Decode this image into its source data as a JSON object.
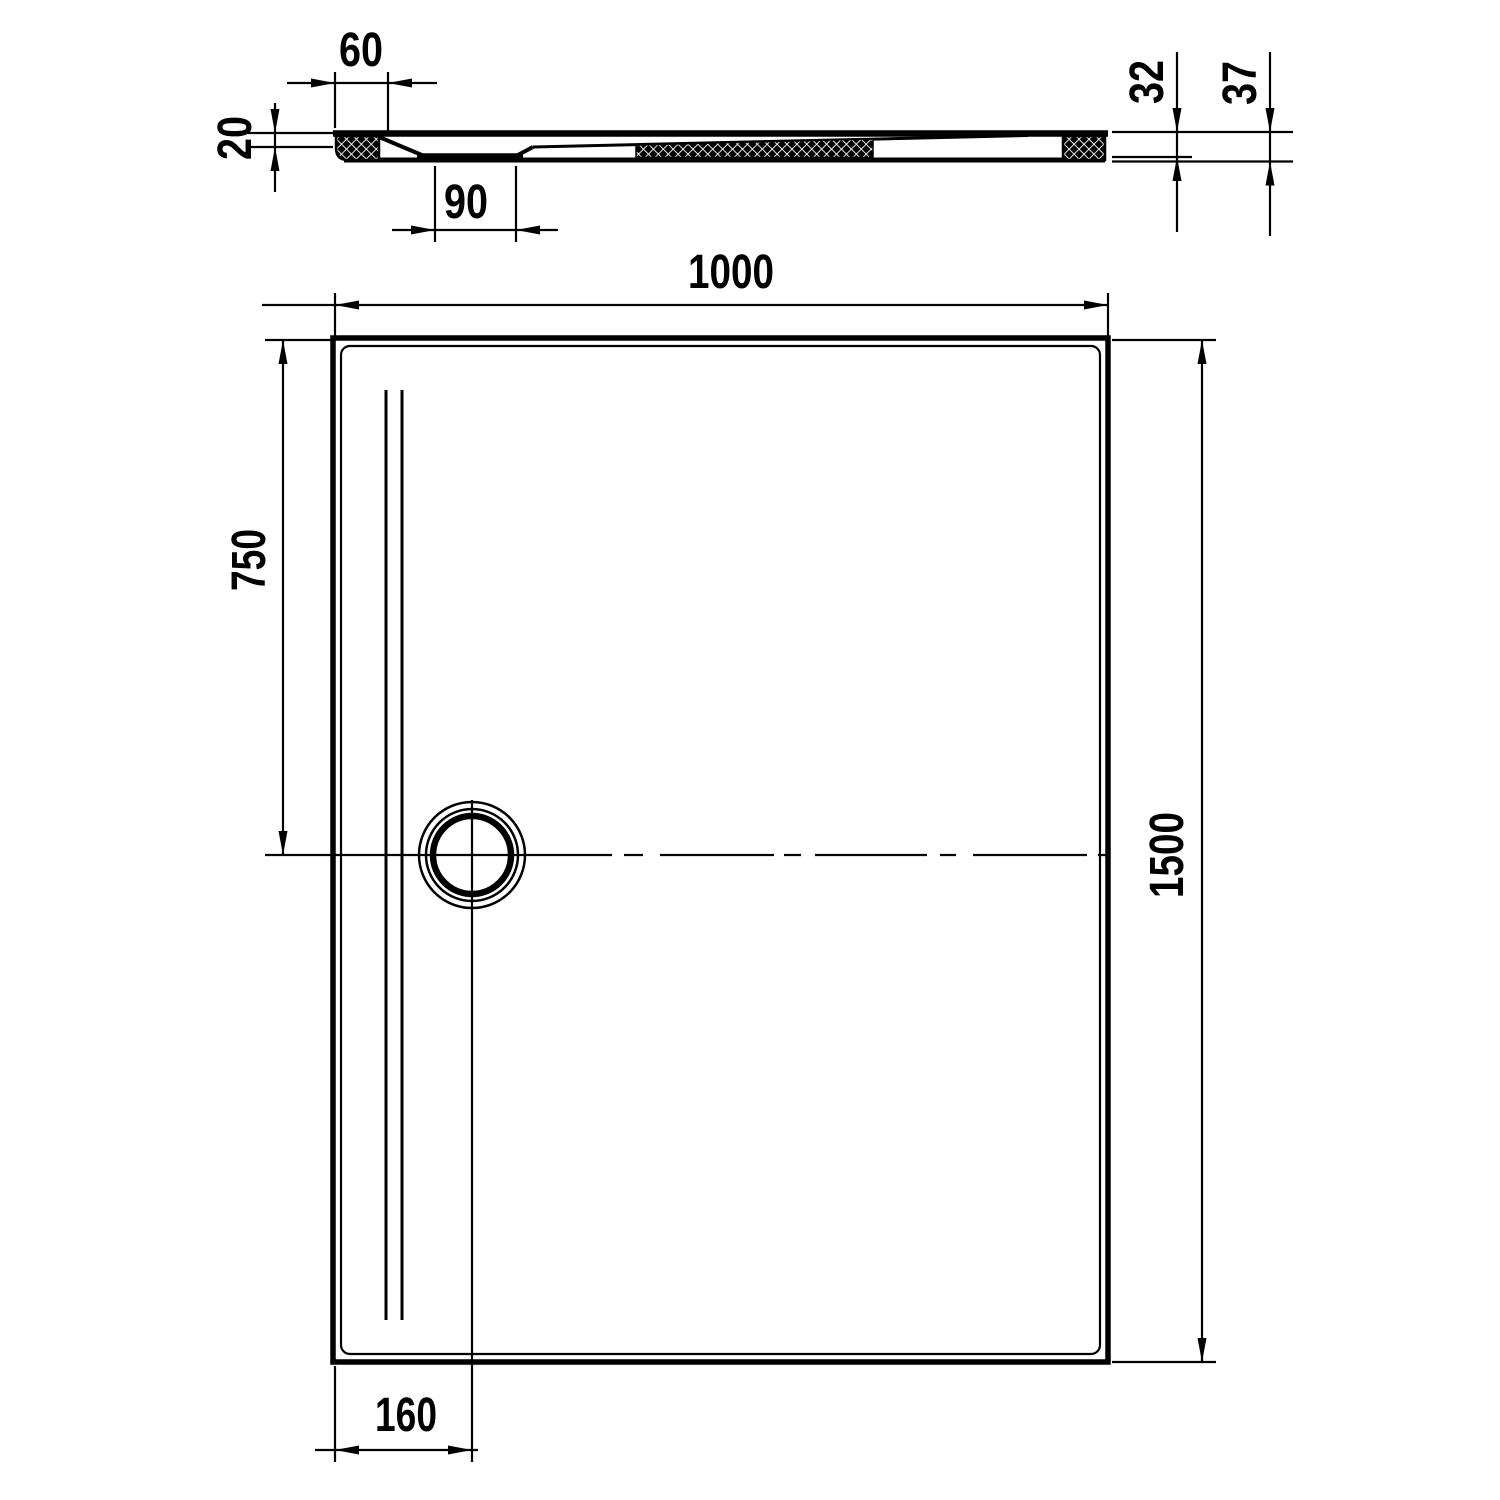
{
  "colors": {
    "line_color": "#000000",
    "background_color": "#ffffff"
  },
  "section_view": {
    "dim_flange_width_top": "60",
    "dim_left_edge_height": "20",
    "dim_sump_width": "90",
    "dim_right_height_inner": "32",
    "dim_right_height_overall": "37"
  },
  "plan_view": {
    "dim_overall_width": "1000",
    "dim_drain_center_from_top": "750",
    "dim_overall_length": "1500",
    "dim_drain_center_from_left": "160"
  }
}
